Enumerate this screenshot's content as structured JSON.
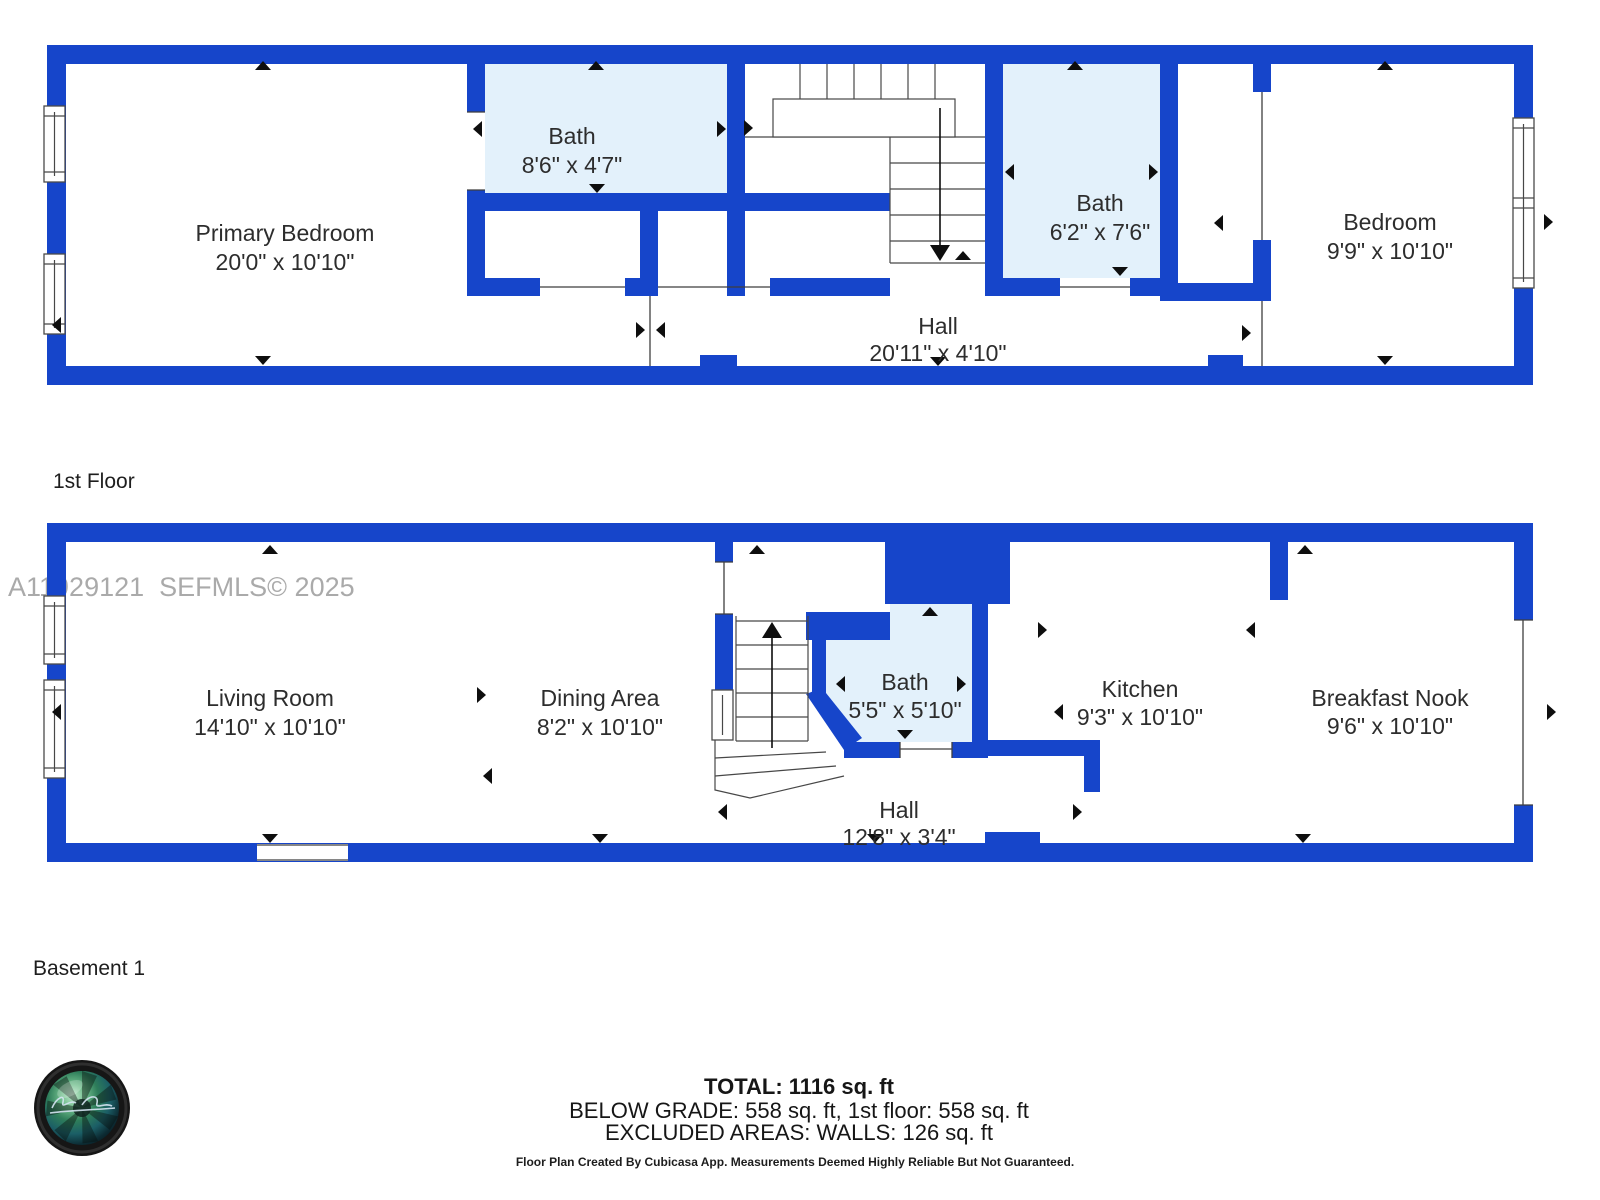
{
  "watermark": "A11929121  SEFMLS© 2025",
  "floors": [
    {
      "label": "1st Floor",
      "rooms": [
        {
          "name": "Primary Bedroom",
          "dims": "20'0\" x 10'10\""
        },
        {
          "name": "Bath",
          "dims": "8'6\" x 4'7\""
        },
        {
          "name": "Bath",
          "dims": "6'2\" x 7'6\""
        },
        {
          "name": "Bedroom",
          "dims": "9'9\" x 10'10\""
        },
        {
          "name": "Hall",
          "dims": "20'11\" x 4'10\""
        }
      ]
    },
    {
      "label": "Basement 1",
      "rooms": [
        {
          "name": "Living Room",
          "dims": "14'10\" x 10'10\""
        },
        {
          "name": "Dining Area",
          "dims": "8'2\" x 10'10\""
        },
        {
          "name": "Bath",
          "dims": "5'5\" x 5'10\""
        },
        {
          "name": "Kitchen",
          "dims": "9'3\" x 10'10\""
        },
        {
          "name": "Breakfast Nook",
          "dims": "9'6\" x 10'10\""
        },
        {
          "name": "Hall",
          "dims": "12'8\" x 3'4\""
        }
      ]
    }
  ],
  "summary": {
    "total": "TOTAL: 1116 sq. ft",
    "breakdown": "BELOW GRADE: 558 sq. ft, 1st floor: 558 sq. ft",
    "excluded": "EXCLUDED AREAS: WALLS: 126 sq. ft",
    "disclaimer": "Floor Plan Created By Cubicasa App. Measurements Deemed Highly Reliable But Not Guaranteed."
  },
  "colors": {
    "wall_blue": "#1645ca",
    "bath_fill": "#e3f1fb"
  }
}
